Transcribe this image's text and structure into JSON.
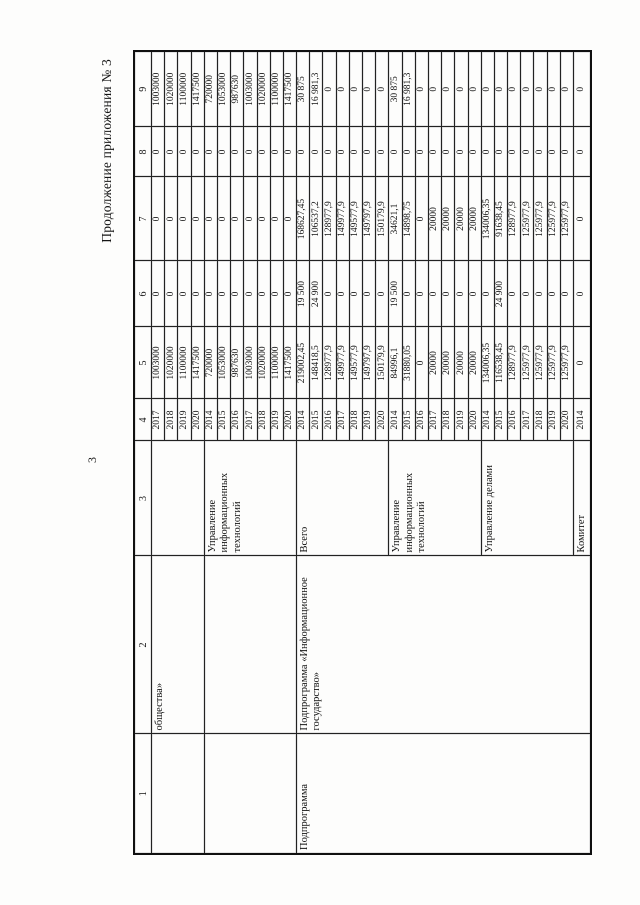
{
  "page": {
    "title": "Продолжение приложения № 3",
    "page_number": "3"
  },
  "colors": {
    "background": "#fdfdfc",
    "ink": "#141414",
    "border": "#222222"
  },
  "table": {
    "col_headers": [
      "1",
      "2",
      "3",
      "4",
      "5",
      "6",
      "7",
      "8",
      "9"
    ],
    "merged_columns": {
      "col1": [
        {
          "span": 4,
          "text": ""
        },
        {
          "span": 7,
          "text": ""
        },
        {
          "span": 22,
          "text": "Подпрограмма"
        }
      ],
      "col2": [
        {
          "span": 4,
          "text": "общества»"
        },
        {
          "span": 7,
          "text": ""
        },
        {
          "span": 22,
          "text": "Подпрограмма «Информационное государство»"
        }
      ],
      "col3": [
        {
          "span": 4,
          "text": ""
        },
        {
          "span": 7,
          "text": "Управление информационных технологий"
        },
        {
          "span": 7,
          "text": "Всего"
        },
        {
          "span": 7,
          "text": "Управление информационных технологий"
        },
        {
          "span": 7,
          "text": "Управление делами"
        },
        {
          "span": 1,
          "text": "Комитет"
        }
      ]
    },
    "rows": [
      {
        "year": "2017",
        "c5": "1003000",
        "c6": "0",
        "c7": "0",
        "c8": "0",
        "c9": "1003000"
      },
      {
        "year": "2018",
        "c5": "1020000",
        "c6": "0",
        "c7": "0",
        "c8": "0",
        "c9": "1020000"
      },
      {
        "year": "2019",
        "c5": "1100000",
        "c6": "0",
        "c7": "0",
        "c8": "0",
        "c9": "1100000"
      },
      {
        "year": "2020",
        "c5": "1417500",
        "c6": "0",
        "c7": "0",
        "c8": "0",
        "c9": "1417500"
      },
      {
        "year": "2014",
        "c5": "720000",
        "c6": "0",
        "c7": "0",
        "c8": "0",
        "c9": "720000"
      },
      {
        "year": "2015",
        "c5": "1053000",
        "c6": "0",
        "c7": "0",
        "c8": "0",
        "c9": "1053000"
      },
      {
        "year": "2016",
        "c5": "987630",
        "c6": "0",
        "c7": "0",
        "c8": "0",
        "c9": "987630"
      },
      {
        "year": "2017",
        "c5": "1003000",
        "c6": "0",
        "c7": "0",
        "c8": "0",
        "c9": "1003000"
      },
      {
        "year": "2018",
        "c5": "1020000",
        "c6": "0",
        "c7": "0",
        "c8": "0",
        "c9": "1020000"
      },
      {
        "year": "2019",
        "c5": "1100000",
        "c6": "0",
        "c7": "0",
        "c8": "0",
        "c9": "1100000"
      },
      {
        "year": "2020",
        "c5": "1417500",
        "c6": "0",
        "c7": "0",
        "c8": "0",
        "c9": "1417500"
      },
      {
        "year": "2014",
        "c5": "219002,45",
        "c6": "19 500",
        "c7": "168627,45",
        "c8": "0",
        "c9": "30 875"
      },
      {
        "year": "2015",
        "c5": "148418,5",
        "c6": "24 900",
        "c7": "106537,2",
        "c8": "0",
        "c9": "16 981,3"
      },
      {
        "year": "2016",
        "c5": "128977,9",
        "c6": "0",
        "c7": "128977,9",
        "c8": "0",
        "c9": "0"
      },
      {
        "year": "2017",
        "c5": "149977,9",
        "c6": "0",
        "c7": "149977,9",
        "c8": "0",
        "c9": "0"
      },
      {
        "year": "2018",
        "c5": "149577,9",
        "c6": "0",
        "c7": "149577,9",
        "c8": "0",
        "c9": "0"
      },
      {
        "year": "2019",
        "c5": "149797,9",
        "c6": "0",
        "c7": "149797,9",
        "c8": "0",
        "c9": "0"
      },
      {
        "year": "2020",
        "c5": "150179,9",
        "c6": "0",
        "c7": "150179,9",
        "c8": "0",
        "c9": "0"
      },
      {
        "year": "2014",
        "c5": "84996,1",
        "c6": "19 500",
        "c7": "34621,1",
        "c8": "0",
        "c9": "30 875"
      },
      {
        "year": "2015",
        "c5": "31880,05",
        "c6": "0",
        "c7": "14898,75",
        "c8": "0",
        "c9": "16 981,3"
      },
      {
        "year": "2016",
        "c5": "0",
        "c6": "0",
        "c7": "0",
        "c8": "0",
        "c9": "0"
      },
      {
        "year": "2017",
        "c5": "20000",
        "c6": "0",
        "c7": "20000",
        "c8": "0",
        "c9": "0"
      },
      {
        "year": "2018",
        "c5": "20000",
        "c6": "0",
        "c7": "20000",
        "c8": "0",
        "c9": "0"
      },
      {
        "year": "2019",
        "c5": "20000",
        "c6": "0",
        "c7": "20000",
        "c8": "0",
        "c9": "0"
      },
      {
        "year": "2020",
        "c5": "20000",
        "c6": "0",
        "c7": "20000",
        "c8": "0",
        "c9": "0"
      },
      {
        "year": "2014",
        "c5": "134006,35",
        "c6": "0",
        "c7": "134006,35",
        "c8": "0",
        "c9": "0"
      },
      {
        "year": "2015",
        "c5": "116538,45",
        "c6": "24 900",
        "c7": "91638,45",
        "c8": "0",
        "c9": "0"
      },
      {
        "year": "2016",
        "c5": "128977,9",
        "c6": "0",
        "c7": "128977,9",
        "c8": "0",
        "c9": "0"
      },
      {
        "year": "2017",
        "c5": "125977,9",
        "c6": "0",
        "c7": "125977,9",
        "c8": "0",
        "c9": "0"
      },
      {
        "year": "2018",
        "c5": "125977,9",
        "c6": "0",
        "c7": "125977,9",
        "c8": "0",
        "c9": "0"
      },
      {
        "year": "2019",
        "c5": "125977,9",
        "c6": "0",
        "c7": "125977,9",
        "c8": "0",
        "c9": "0"
      },
      {
        "year": "2020",
        "c5": "125977,9",
        "c6": "0",
        "c7": "125977,9",
        "c8": "0",
        "c9": "0"
      },
      {
        "year": "2014",
        "c5": "0",
        "c6": "0",
        "c7": "0",
        "c8": "0",
        "c9": "0"
      }
    ]
  }
}
